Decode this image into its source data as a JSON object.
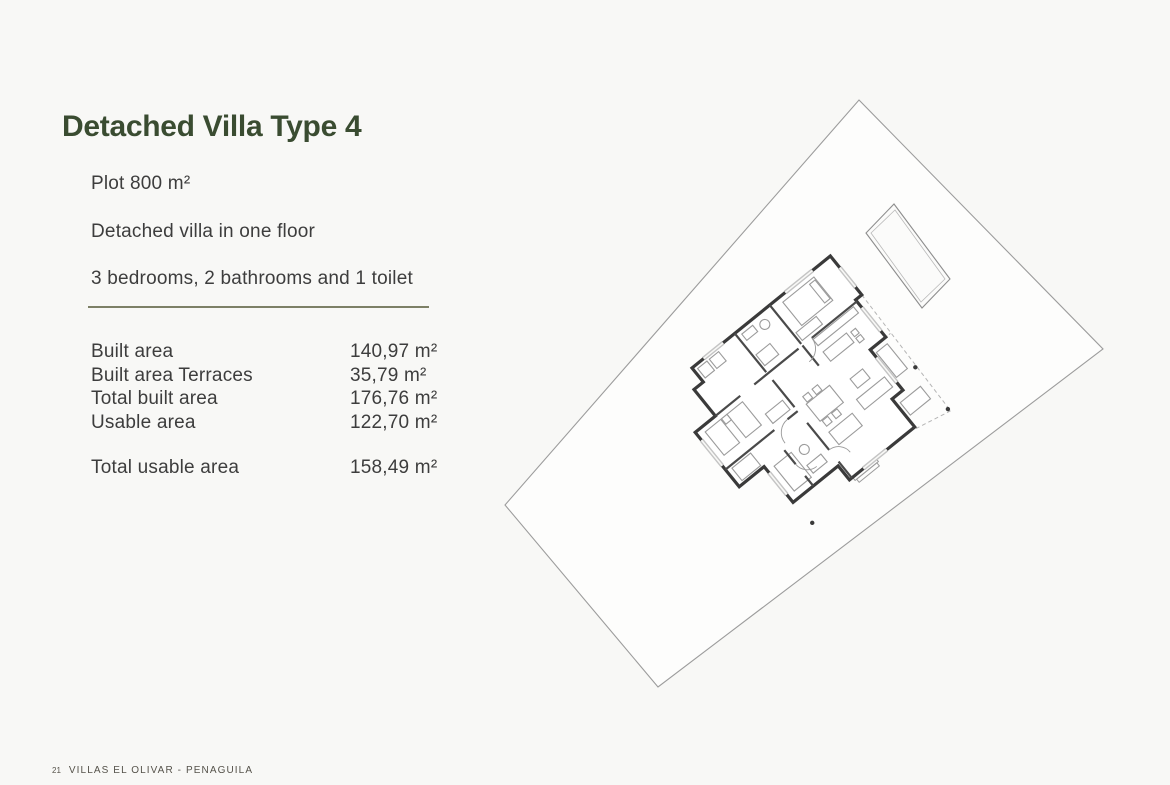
{
  "page": {
    "title": "Detached Villa Type 4",
    "intro_lines": [
      "Plot 800 m²",
      "Detached villa in one floor",
      "3 bedrooms, 2 bathrooms and 1 toilet"
    ],
    "specs": [
      {
        "label": "Built area",
        "value": "140,97 m²"
      },
      {
        "label": "Built area Terraces",
        "value": "35,79 m²"
      },
      {
        "label": "Total built area",
        "value": "176,76 m²"
      },
      {
        "label": "Usable area",
        "value": "122,70 m²"
      }
    ],
    "total": {
      "label": "Total usable area",
      "value": "158,49 m²"
    },
    "footer": {
      "page_number": "21",
      "project": "VILLAS EL OLIVAR - PENAGUILA"
    },
    "colors": {
      "background": "#f8f8f6",
      "accent_green": "#3a4c31",
      "divider_olive": "#7d8066",
      "body_text": "#3d3d3d",
      "plan_line": "#9c9c9c",
      "wall_line": "#3a3a3a"
    },
    "floor_plan": {
      "description": "Rotated site plan of detached villa with plot boundary, swimming pool, covered terrace and floor layout",
      "elements": [
        "plot-boundary",
        "swimming-pool",
        "villa-floor-plan",
        "terrace",
        "entrance-steps"
      ]
    }
  }
}
